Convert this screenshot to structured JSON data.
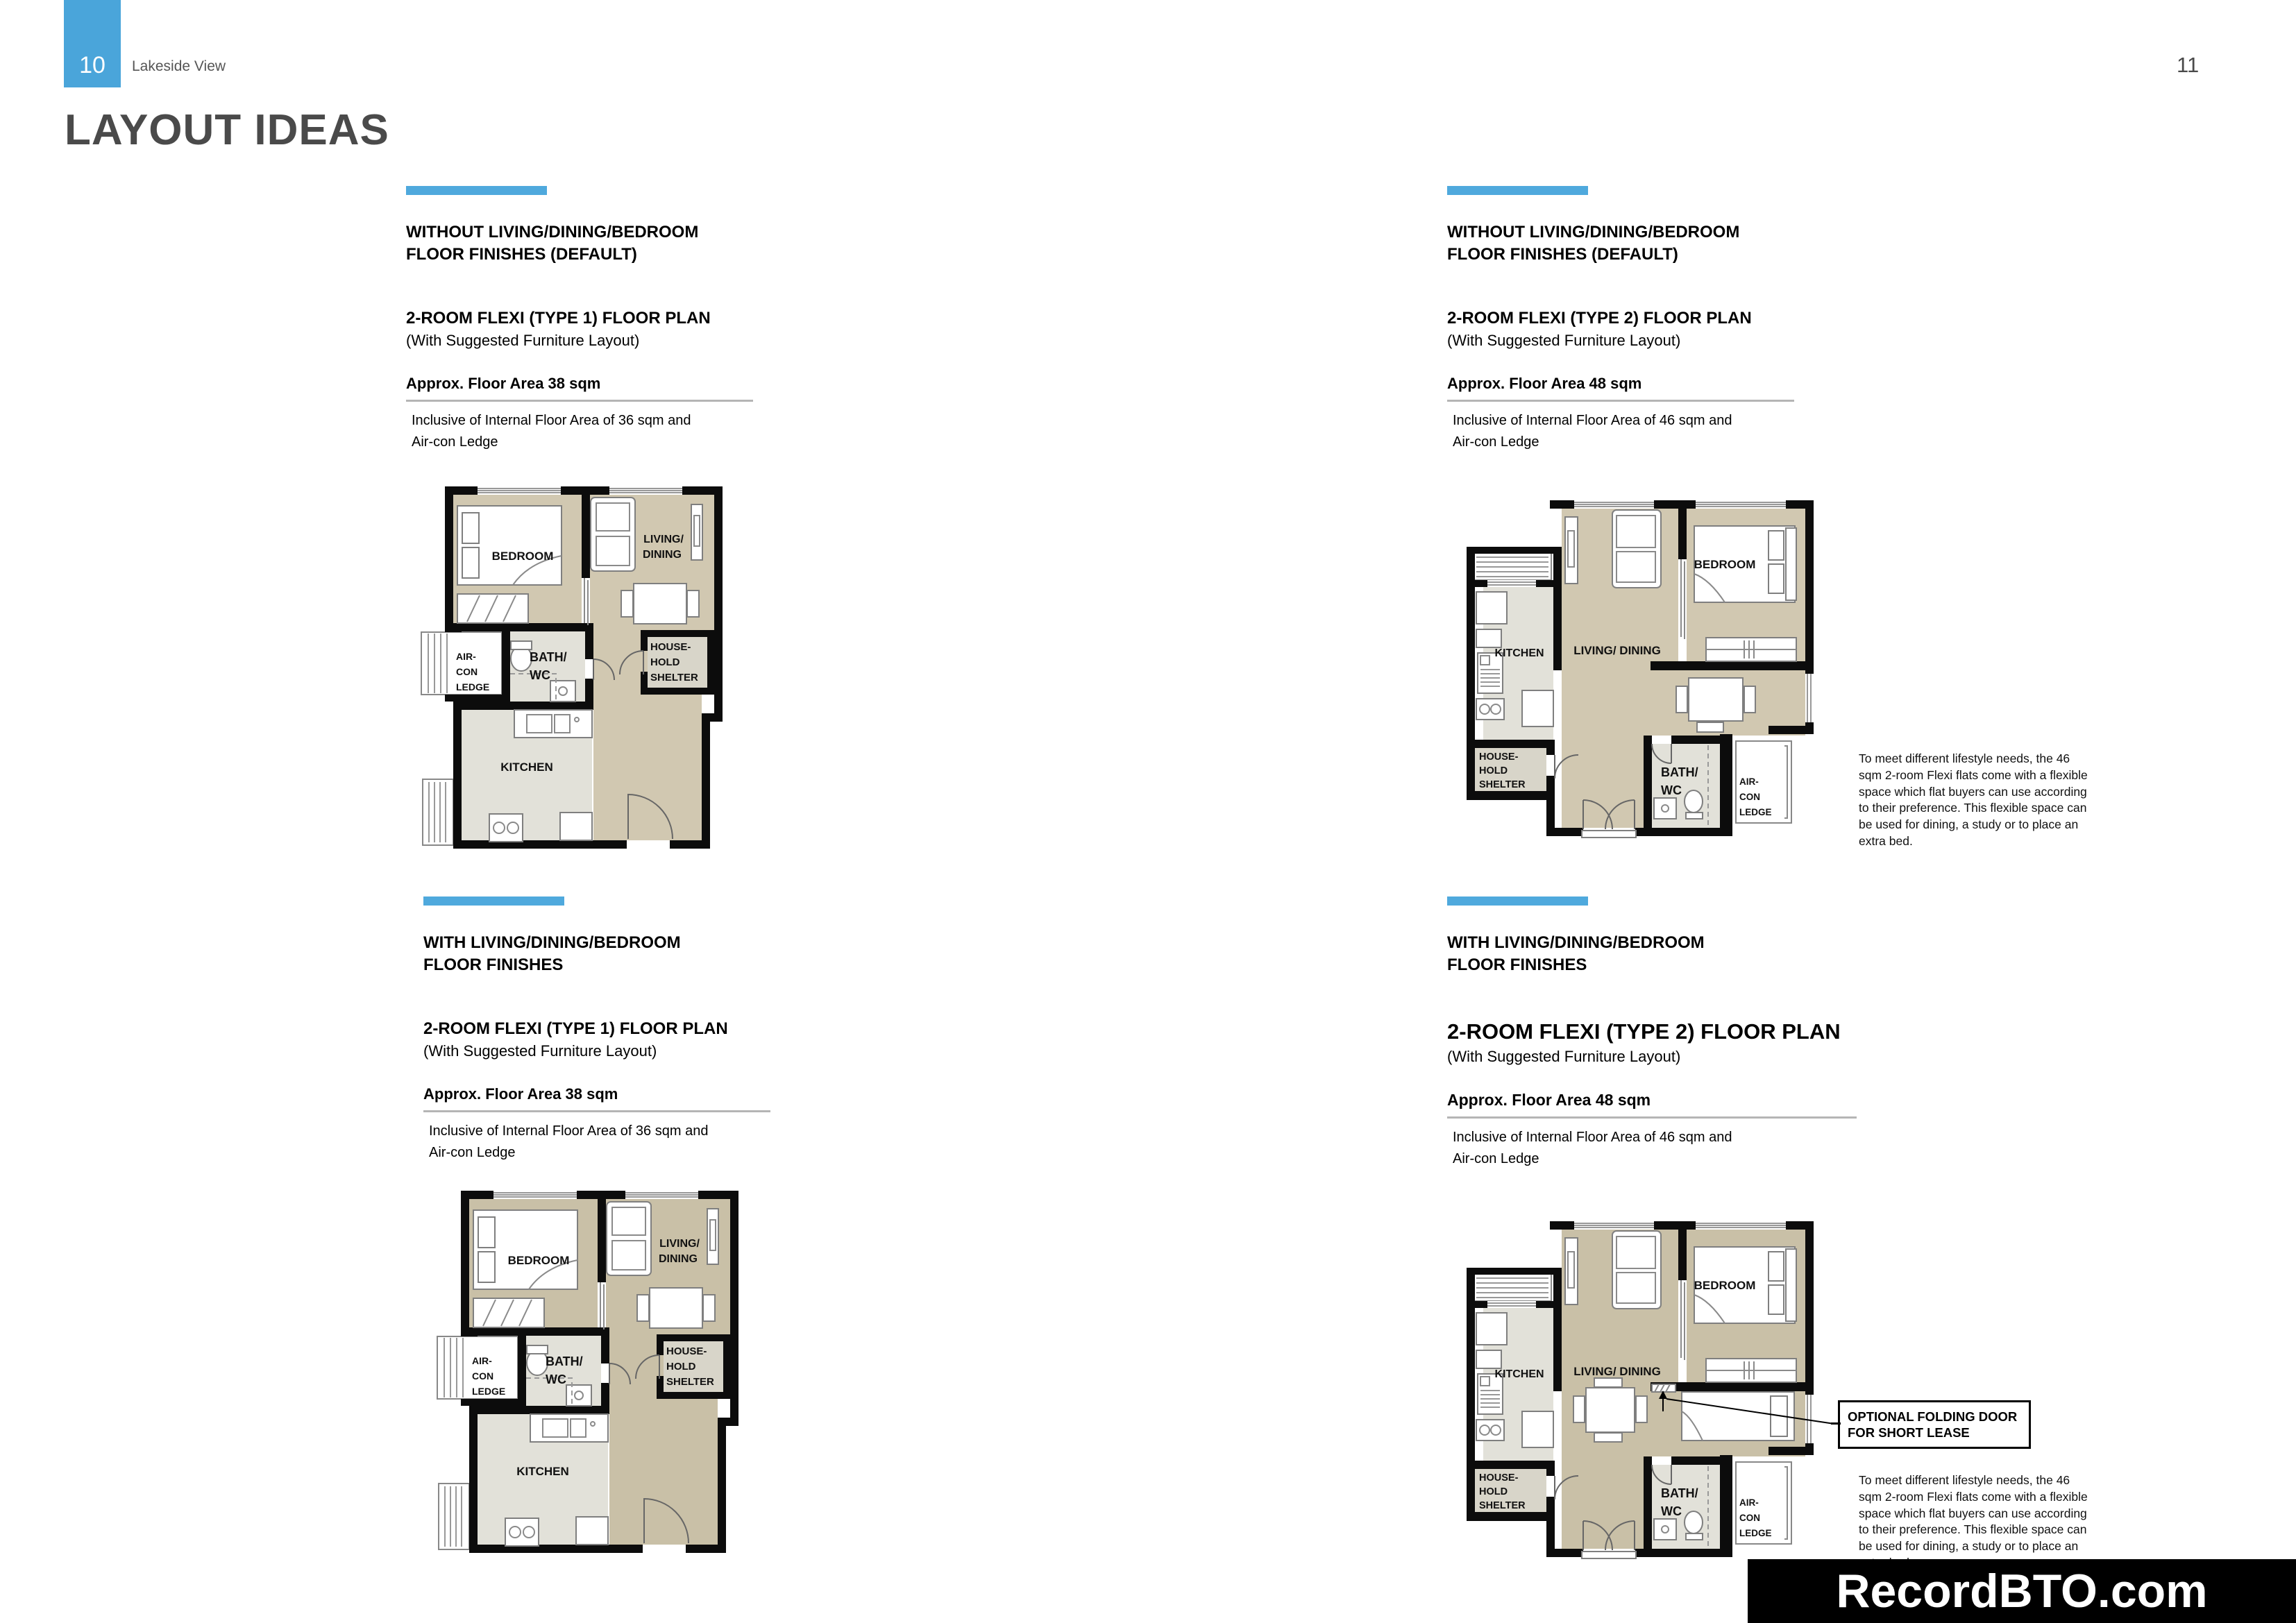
{
  "page": {
    "left_page_number": "10",
    "brand": "Lakeside View",
    "right_page_number": "11",
    "title": "LAYOUT IDEAS",
    "watermark": "RecordBTO.com"
  },
  "colors": {
    "accent_blue": "#4fa9dd",
    "page_number_box_blue": "#4aa5da",
    "title_grey": "#4a4a4a",
    "floor_tan_without_finishes": "#d1c8b1",
    "floor_tan_with_finishes": "#c9c0a7",
    "floor_service_grey": "#e2e1d9",
    "shelter_grey": "#d8d5c9",
    "wall_black": "#0c0c0c",
    "watermark_background": "#000000"
  },
  "rooms": {
    "bedroom": "BEDROOM",
    "living_line1": "LIVING/",
    "living_line2": "DINING",
    "living_inline": "LIVING/ DINING",
    "kitchen": "KITCHEN",
    "bath_line1": "BATH/",
    "bath_line2": "WC",
    "aircon_line1": "AIR-",
    "aircon_line2": "CON",
    "aircon_line3": "LEDGE",
    "shelter_line1": "HOUSE-",
    "shelter_line2": "HOLD",
    "shelter_line3": "SHELTER"
  },
  "sections": [
    {
      "heading_line1": "WITHOUT LIVING/DINING/BEDROOM",
      "heading_line2": "FLOOR FINISHES (DEFAULT)",
      "plan_title": "2-ROOM FLEXI (TYPE 1) FLOOR PLAN",
      "plan_subtitle": "(With Suggested Furniture Layout)",
      "floor_area": "Approx. Floor Area 38 sqm",
      "inclusive_line1": "Inclusive of Internal Floor Area of 36 sqm and",
      "inclusive_line2": "Air-con Ledge"
    },
    {
      "heading_line1": "WITHOUT LIVING/DINING/BEDROOM",
      "heading_line2": "FLOOR FINISHES (DEFAULT)",
      "plan_title": "2-ROOM FLEXI (TYPE 2) FLOOR PLAN",
      "plan_subtitle": "(With Suggested Furniture Layout)",
      "floor_area": "Approx. Floor Area 48 sqm",
      "inclusive_line1": "Inclusive of Internal Floor Area of 46 sqm and",
      "inclusive_line2": "Air-con Ledge",
      "note": "To meet different lifestyle needs, the 46 sqm 2-room Flexi flats come with a flexible space which flat buyers can use according to their preference. This flexible space can be used for dining, a study or to place an extra bed."
    },
    {
      "heading_line1": "WITH LIVING/DINING/BEDROOM",
      "heading_line2": "FLOOR FINISHES",
      "plan_title": "2-ROOM FLEXI (TYPE 1) FLOOR PLAN",
      "plan_subtitle": "(With Suggested Furniture Layout)",
      "floor_area": "Approx. Floor Area 38 sqm",
      "inclusive_line1": "Inclusive of Internal Floor Area of 36 sqm and",
      "inclusive_line2": "Air-con Ledge"
    },
    {
      "heading_line1": "WITH LIVING/DINING/BEDROOM",
      "heading_line2": "FLOOR FINISHES",
      "plan_title": "2-ROOM FLEXI (TYPE 2) FLOOR PLAN",
      "plan_subtitle": "(With Suggested Furniture Layout)",
      "floor_area": "Approx. Floor Area 48 sqm",
      "inclusive_line1": "Inclusive of Internal Floor Area of 46 sqm and",
      "inclusive_line2": "Air-con Ledge",
      "note": "To meet different lifestyle needs, the 46 sqm 2-room Flexi flats come with a flexible space which flat buyers can use according to their preference. This flexible space can be used for dining, a study or to place an extra bed.",
      "callout_line1": "OPTIONAL FOLDING DOOR",
      "callout_line2": "FOR SHORT LEASE"
    }
  ]
}
